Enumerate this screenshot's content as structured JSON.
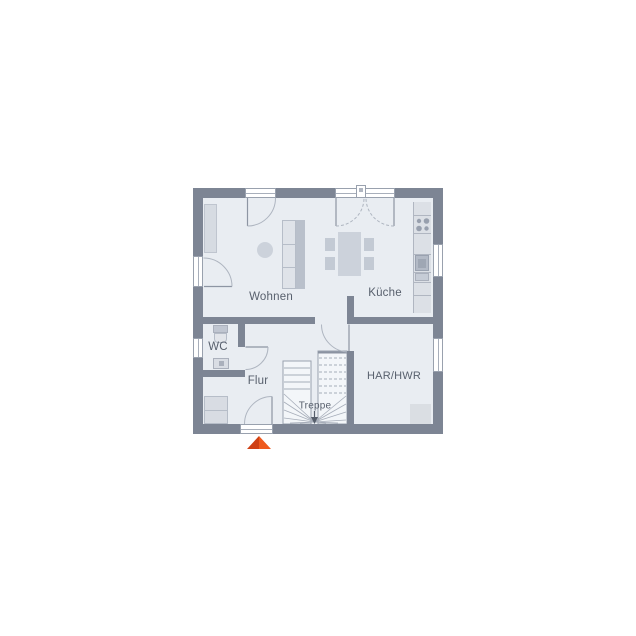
{
  "floorplan": {
    "rooms": [
      {
        "id": "wohnen",
        "label": "Wohnen"
      },
      {
        "id": "kueche",
        "label": "Küche"
      },
      {
        "id": "wc",
        "label": "WC"
      },
      {
        "id": "flur",
        "label": "Flur"
      },
      {
        "id": "treppe",
        "label": "Treppe"
      },
      {
        "id": "har-hwr",
        "label": "HAR/HWR"
      }
    ],
    "colors": {
      "wall": "#7d8594",
      "floor": "#e9edf2",
      "stair_fill": "#f3f6f9",
      "furniture": "#d6dbe2",
      "label_text": "#58606d",
      "entrance_marker": "#e64c19"
    },
    "entrance_marker": {
      "shape": "triangle-up",
      "position": "bottom-center",
      "color": "#e64c19"
    }
  }
}
